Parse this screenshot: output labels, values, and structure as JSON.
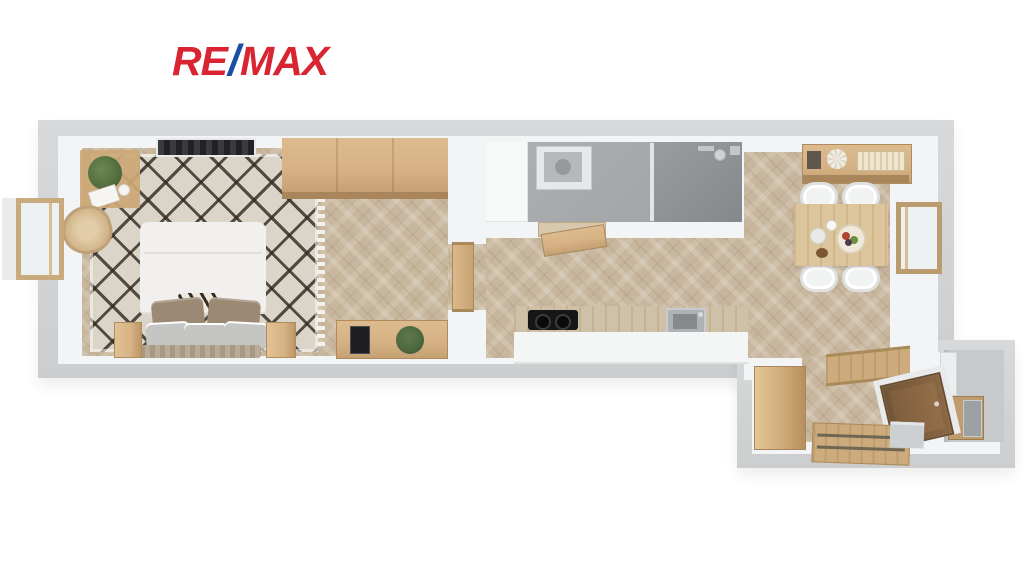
{
  "logo": {
    "re": "RE",
    "slash": "/",
    "max": "MAX"
  },
  "scene": {
    "type": "3d-floor-plan-top-view",
    "description": "Rendered top-down 3D floor plan of a narrow one-bedroom apartment",
    "rooms": [
      {
        "id": "bedroom",
        "features": [
          "double-bed",
          "pillows",
          "berber-rug",
          "wardrobe",
          "nightstands",
          "desk-with-plant",
          "rattan-chair",
          "console-with-plant",
          "radiator-grille",
          "casement-window-left"
        ]
      },
      {
        "id": "bathroom",
        "features": [
          "washing-machine",
          "walk-in-shower",
          "glass-partition",
          "built-in-cabinet",
          "open-wooden-door",
          "wall-fixtures"
        ]
      },
      {
        "id": "kitchen-living-dining",
        "features": [
          "kitchen-counter",
          "cooktop",
          "sink",
          "dining-table",
          "four-chairs",
          "fruit-bowl",
          "sideboard-with-books",
          "casement-window-right",
          "open-door-to-bedroom"
        ]
      },
      {
        "id": "entry-hall",
        "features": [
          "built-in-wardrobe",
          "front-door",
          "wooden-threshold",
          "floor-rails",
          "storage-niche-with-cabinet"
        ]
      }
    ]
  },
  "colors": {
    "background": "#ffffff",
    "brand_red": "#d92432",
    "brand_blue": "#1a4fa3",
    "wall_outer": "#d3d5d7",
    "wall_inner": "#f3f4f5",
    "floor_wood": "#c8b79e",
    "rug_base": "#dbd4c8",
    "rug_pattern": "#332b22",
    "oak": "#d6b284",
    "oak_dark": "#a8855b",
    "bath_floor": "#a7a9ab",
    "shower_floor": "#8f9295",
    "black_appliance": "#161618",
    "white_furniture": "#f1f0ee",
    "headboard_gray": "#b3a590",
    "pillow_taupe": "#9b8973",
    "pillow_gray": "#c5c6c4",
    "plant_green": "#55703f",
    "door_brown": "#8a6644",
    "glass": "#eef1f2"
  }
}
